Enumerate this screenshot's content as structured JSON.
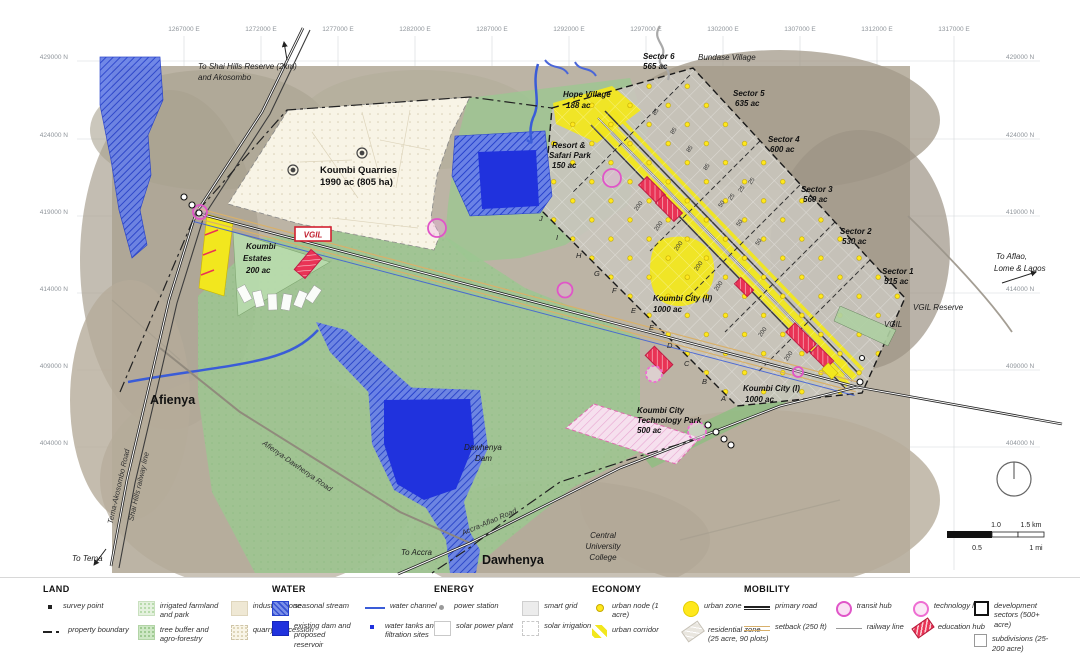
{
  "map": {
    "grid": {
      "top": [
        "1267000 E",
        "1272000 E",
        "1277000 E",
        "1282000 E",
        "1287000 E",
        "1292000 E",
        "1297000 E",
        "1302000 E",
        "1307000 E",
        "1312000 E",
        "1317000 E"
      ],
      "left": [
        "429000 N",
        "424000 N",
        "419000 N",
        "414000 N",
        "409000 N",
        "404000 N"
      ],
      "right": [
        "429000 N",
        "424000 N",
        "419000 N",
        "414000 N",
        "409000 N",
        "404000 N"
      ]
    },
    "sectors": [
      {
        "name": "Sector 6",
        "area": "565 ac"
      },
      {
        "name": "Sector 5",
        "area": "635 ac"
      },
      {
        "name": "Sector 4",
        "area": "600 ac"
      },
      {
        "name": "Sector 3",
        "area": "560 ac"
      },
      {
        "name": "Sector 2",
        "area": "530 ac"
      },
      {
        "name": "Sector 1",
        "area": "515 ac"
      }
    ],
    "labels": {
      "to_shai1": "To Shai Hills Reserve (2km)",
      "to_shai2": "and Akosombo",
      "bundase": "Bundase Village",
      "hope1": "Hope Village",
      "hope2": "188 ac",
      "resort1": "Resort &",
      "resort2": "Safari Park",
      "resort3": "150 ac",
      "quarries1": "Koumbi Quarries",
      "quarries2": "1990 ac (805 ha)",
      "estates1": "Koumbi",
      "estates2": "Estates",
      "estates3": "200 ac",
      "vgil": "VGIL",
      "kc2a": "Koumbi City (II)",
      "kc2b": "1000 ac",
      "kc1a": "Koumbi City (I)",
      "kc1b": "1000 ac",
      "tech1": "Koumbi City",
      "tech2": "Technology Park",
      "tech3": "500 ac",
      "vgil_reserve": "VGIL Reserve",
      "vgil_small": "VGIL",
      "aflao1": "To Aflao,",
      "aflao2": "Lome & Lagos",
      "afienya": "Afienya",
      "dawhenya": "Dawhenya",
      "dam1": "Dawhenya",
      "dam2": "Dam",
      "cuc1": "Central",
      "cuc2": "University",
      "cuc3": "College",
      "to_tema": "To Tema",
      "to_accra": "To Accra",
      "road_tema": "Tema-Akosombo Road",
      "road_rail": "Shai Hills railway line",
      "road_afienya": "Afienya-Dawhenya Road",
      "road_accra": "Accra-Aflao Road"
    },
    "letters": [
      "J",
      "I",
      "H",
      "G",
      "F",
      "E",
      "E",
      "D",
      "C",
      "B",
      "A"
    ],
    "plot200": "200",
    "plot85": "85",
    "plot50": "50",
    "plot25": "25",
    "scalebar": {
      "km1": "1.0",
      "km2": "1.5 km",
      "mi1": "0.5",
      "mi2": "1 mi"
    }
  },
  "legend": {
    "groups": [
      {
        "title": "LAND",
        "items": [
          {
            "label": "survey point"
          },
          {
            "label": "property boundary"
          },
          {
            "label": "irrigated farmland and park"
          },
          {
            "label": "tree buffer and agro-forestry"
          },
          {
            "label": "industrial zone"
          },
          {
            "label": "quarry concession"
          }
        ]
      },
      {
        "title": "WATER",
        "items": [
          {
            "label": "seasonal stream"
          },
          {
            "label": "existing dam and proposed reservoir"
          },
          {
            "label": "water channel"
          },
          {
            "label": "water tanks and filtration sites"
          }
        ]
      },
      {
        "title": "ENERGY",
        "items": [
          {
            "label": "power station"
          },
          {
            "label": "solar power plant"
          },
          {
            "label": "smart grid"
          },
          {
            "label": "solar irrigation"
          }
        ]
      },
      {
        "title": "ECONOMY",
        "items": [
          {
            "label": "urban node (1 acre)"
          },
          {
            "label": "urban corridor"
          },
          {
            "label": "urban zone"
          },
          {
            "label": "residential zone (25 acre, 90 plots)"
          }
        ]
      },
      {
        "title": "MOBILITY",
        "items": [
          {
            "label": "primary road"
          },
          {
            "label": "setback (250 ft)"
          },
          {
            "label": "transit hub"
          },
          {
            "label": "railway line"
          },
          {
            "label": "technology hub"
          },
          {
            "label": "education hub"
          }
        ]
      },
      {
        "title": "",
        "items": [
          {
            "label": "development sectors (500+ acre)"
          },
          {
            "label": "subdivisions (25-200 acre)"
          }
        ]
      }
    ]
  }
}
